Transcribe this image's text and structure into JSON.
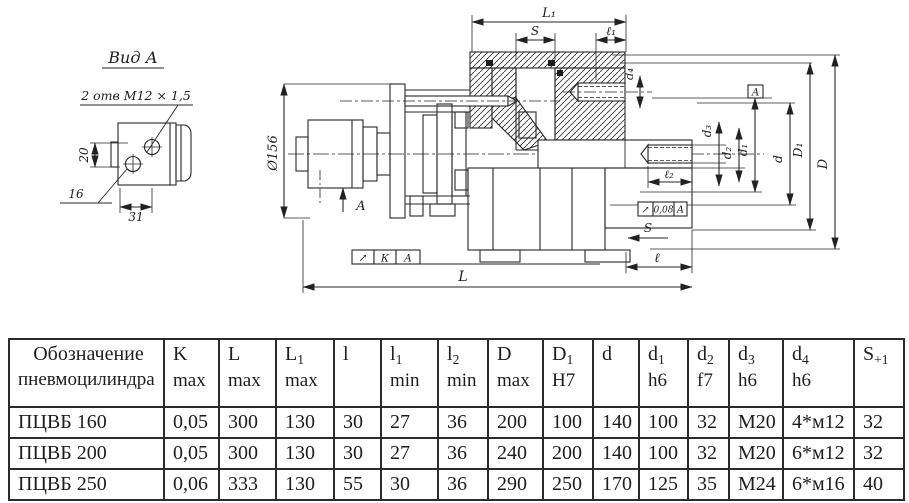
{
  "drawing": {
    "detail_view": {
      "title": "Вид А",
      "callout": "2 отв  М12 × 1,5",
      "dim_20": "20",
      "dim_16": "16",
      "dim_31": "31"
    },
    "main_view": {
      "dia156": "Ø156",
      "dim_L1": "L₁",
      "dim_S_top": "S",
      "dim_l1": "ℓ₁",
      "dim_d4": "d₄",
      "dim_d3": "d₃",
      "dim_d2": "d₂",
      "dim_d1": "d₁",
      "dim_d": "d",
      "dim_D1": "D₁",
      "dim_D": "D",
      "dim_l2": "ℓ₂",
      "dim_s_small": "S",
      "dim_l": "ℓ",
      "dim_L": "L",
      "view_arrow_label": "А",
      "datum_label": "А",
      "tolerance_runout": {
        "symbol": "↗",
        "value": "0,08",
        "datum": "А"
      },
      "tolerance_k": {
        "symbol": "↗",
        "value": "К",
        "datum": "А"
      }
    }
  },
  "table": {
    "col_headers": [
      {
        "line1": "Обозначение",
        "sub": "",
        "line2": "пневмоцилиндра"
      },
      {
        "line1": "K",
        "sub": "",
        "line2": "max"
      },
      {
        "line1": "L",
        "sub": "",
        "line2": "max"
      },
      {
        "line1": "L",
        "sub": "1",
        "line2": "max"
      },
      {
        "line1": "l",
        "sub": "",
        "line2": ""
      },
      {
        "line1": "l",
        "sub": "1",
        "line2": "min"
      },
      {
        "line1": "l",
        "sub": "2",
        "line2": "min"
      },
      {
        "line1": "D",
        "sub": "",
        "line2": "max"
      },
      {
        "line1": "D",
        "sub": "1",
        "line2": "H7"
      },
      {
        "line1": "d",
        "sub": "",
        "line2": ""
      },
      {
        "line1": "d",
        "sub": "1",
        "line2": "h6"
      },
      {
        "line1": "d",
        "sub": "2",
        "line2": "f7"
      },
      {
        "line1": "d",
        "sub": "3",
        "line2": "h6"
      },
      {
        "line1": "d",
        "sub": "4",
        "line2": "h6"
      },
      {
        "line1": "S",
        "sub": "+1",
        "line2": ""
      }
    ],
    "rows": [
      {
        "name": "ПЦВБ 160",
        "values": [
          "0,05",
          "300",
          "130",
          "30",
          "27",
          "36",
          "200",
          "100",
          "140",
          "100",
          "32",
          "М20",
          "4*м12",
          "32"
        ]
      },
      {
        "name": "ПЦВБ 200",
        "values": [
          "0,05",
          "300",
          "130",
          "30",
          "27",
          "36",
          "240",
          "200",
          "140",
          "100",
          "32",
          "М20",
          "6*м12",
          "32"
        ]
      },
      {
        "name": "ПЦВБ 250",
        "values": [
          "0,06",
          "333",
          "130",
          "55",
          "30",
          "36",
          "290",
          "250",
          "170",
          "125",
          "35",
          "М24",
          "6*м16",
          "40"
        ]
      }
    ]
  }
}
